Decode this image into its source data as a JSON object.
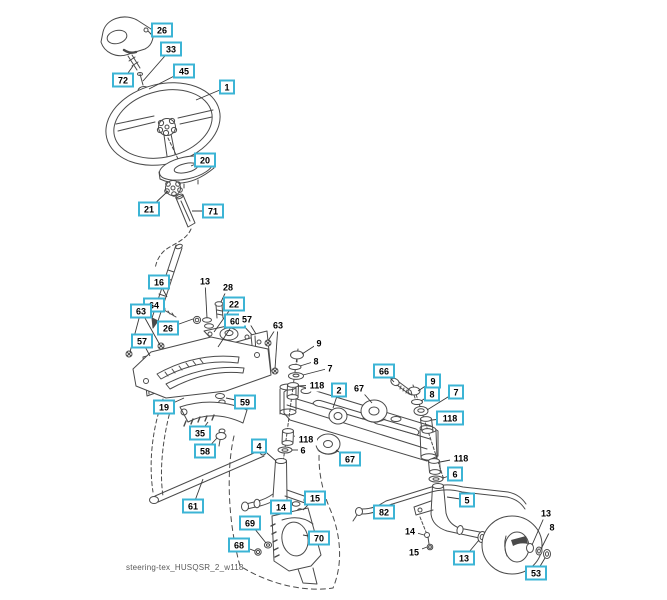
{
  "diagram": {
    "footer": "steering-tex_HUSQSR_2_w118",
    "colors": {
      "callout_border": "#3cb4d5",
      "callout_text": "#000000",
      "line": "#4a4a4a",
      "footer_text": "#595959",
      "background": "#ffffff"
    },
    "callouts": [
      {
        "label": "26",
        "x": 162,
        "y": 30,
        "boxed": true,
        "leaders": [
          [
            150,
            34
          ]
        ]
      },
      {
        "label": "33",
        "x": 171,
        "y": 49,
        "boxed": true,
        "leaders": [
          [
            143,
            81
          ]
        ]
      },
      {
        "label": "45",
        "x": 184,
        "y": 71,
        "boxed": true,
        "leaders": [
          [
            149,
            89
          ]
        ]
      },
      {
        "label": "72",
        "x": 123,
        "y": 80,
        "boxed": true,
        "leaders": [
          [
            133,
            66
          ]
        ]
      },
      {
        "label": "1",
        "x": 227,
        "y": 87,
        "boxed": true,
        "leaders": [
          [
            196,
            100
          ]
        ]
      },
      {
        "label": "20",
        "x": 205,
        "y": 160,
        "boxed": true,
        "leaders": [
          [
            191,
            166
          ]
        ]
      },
      {
        "label": "21",
        "x": 149,
        "y": 209,
        "boxed": true,
        "leaders": [
          [
            168,
            191
          ]
        ]
      },
      {
        "label": "71",
        "x": 213,
        "y": 211,
        "boxed": true,
        "leaders": [
          [
            192,
            211
          ]
        ]
      },
      {
        "label": "16",
        "x": 159,
        "y": 282,
        "boxed": true,
        "leaders": [
          [
            167,
            297
          ]
        ]
      },
      {
        "label": "13",
        "x": 205,
        "y": 281,
        "boxed": false,
        "leaders": [
          [
            207,
            318
          ]
        ]
      },
      {
        "label": "28",
        "x": 228,
        "y": 287,
        "boxed": false,
        "leaders": [
          [
            221,
            302
          ]
        ]
      },
      {
        "label": "64",
        "x": 154,
        "y": 305,
        "boxed": true,
        "leaders": [
          [
            162,
            309
          ]
        ]
      },
      {
        "label": "22",
        "x": 234,
        "y": 304,
        "boxed": true,
        "leaders": [
          [
            214,
            332
          ]
        ]
      },
      {
        "label": "63",
        "x": 141,
        "y": 311,
        "boxed": true,
        "leaders": [
          [
            130,
            352
          ],
          [
            160,
            345
          ]
        ]
      },
      {
        "label": "26",
        "x": 168,
        "y": 328,
        "boxed": true,
        "leaders": [
          [
            193,
            319
          ]
        ]
      },
      {
        "label": "60",
        "x": 235,
        "y": 321,
        "boxed": true,
        "leaders": [
          [
            218,
            347
          ]
        ]
      },
      {
        "label": "57",
        "x": 247,
        "y": 319,
        "boxed": false,
        "leaders": [
          [
            256,
            334
          ]
        ]
      },
      {
        "label": "63",
        "x": 278,
        "y": 325,
        "boxed": false,
        "leaders": [
          [
            268,
            341
          ],
          [
            275,
            369
          ]
        ]
      },
      {
        "label": "57",
        "x": 142,
        "y": 341,
        "boxed": true,
        "leaders": [
          [
            150,
            356
          ]
        ]
      },
      {
        "label": "9",
        "x": 319,
        "y": 343,
        "boxed": false,
        "leaders": [
          [
            302,
            354
          ]
        ]
      },
      {
        "label": "8",
        "x": 316,
        "y": 361,
        "boxed": false,
        "leaders": [
          [
            300,
            366
          ]
        ]
      },
      {
        "label": "7",
        "x": 330,
        "y": 368,
        "boxed": false,
        "leaders": [
          [
            303,
            375
          ]
        ]
      },
      {
        "label": "118",
        "x": 317,
        "y": 385,
        "boxed": false,
        "leaders": [
          [
            298,
            386
          ]
        ]
      },
      {
        "label": "2",
        "x": 339,
        "y": 390,
        "boxed": true,
        "leaders": [
          [
            333,
            408
          ]
        ]
      },
      {
        "label": "67",
        "x": 359,
        "y": 388,
        "boxed": false,
        "leaders": [
          [
            372,
            403
          ]
        ]
      },
      {
        "label": "66",
        "x": 384,
        "y": 371,
        "boxed": true,
        "leaders": [
          [
            394,
            382
          ]
        ]
      },
      {
        "label": "9",
        "x": 433,
        "y": 381,
        "boxed": true,
        "leaders": [
          [
            418,
            391
          ]
        ]
      },
      {
        "label": "8",
        "x": 432,
        "y": 394,
        "boxed": true,
        "leaders": [
          [
            421,
            401
          ]
        ]
      },
      {
        "label": "7",
        "x": 456,
        "y": 392,
        "boxed": true,
        "leaders": [
          [
            427,
            410
          ]
        ]
      },
      {
        "label": "118",
        "x": 450,
        "y": 418,
        "boxed": true,
        "leaders": [
          [
            432,
            420
          ]
        ]
      },
      {
        "label": "19",
        "x": 164,
        "y": 407,
        "boxed": true,
        "leaders": [
          [
            184,
            398
          ]
        ]
      },
      {
        "label": "59",
        "x": 245,
        "y": 402,
        "boxed": true,
        "leaders": [
          [
            226,
            398
          ]
        ]
      },
      {
        "label": "35",
        "x": 200,
        "y": 433,
        "boxed": true,
        "leaders": [
          [
            208,
            422
          ]
        ]
      },
      {
        "label": "58",
        "x": 205,
        "y": 451,
        "boxed": true,
        "leaders": [
          [
            217,
            438
          ]
        ]
      },
      {
        "label": "118",
        "x": 306,
        "y": 439,
        "boxed": false,
        "leaders": [
          [
            294,
            436
          ]
        ]
      },
      {
        "label": "6",
        "x": 303,
        "y": 450,
        "boxed": false,
        "leaders": [
          [
            292,
            450
          ]
        ]
      },
      {
        "label": "4",
        "x": 259,
        "y": 446,
        "boxed": true,
        "leaders": [
          [
            276,
            461
          ]
        ]
      },
      {
        "label": "67",
        "x": 350,
        "y": 459,
        "boxed": true,
        "leaders": [
          [
            336,
            450
          ]
        ]
      },
      {
        "label": "61",
        "x": 193,
        "y": 506,
        "boxed": true,
        "leaders": [
          [
            203,
            479
          ]
        ]
      },
      {
        "label": "15",
        "x": 315,
        "y": 498,
        "boxed": true,
        "leaders": [
          [
            303,
            510
          ]
        ]
      },
      {
        "label": "14",
        "x": 281,
        "y": 507,
        "boxed": true,
        "leaders": [
          [
            293,
            504
          ]
        ]
      },
      {
        "label": "82",
        "x": 384,
        "y": 512,
        "boxed": true,
        "leaders": [
          [
            392,
            504
          ]
        ]
      },
      {
        "label": "69",
        "x": 250,
        "y": 523,
        "boxed": true,
        "leaders": [
          [
            266,
            543
          ]
        ]
      },
      {
        "label": "68",
        "x": 239,
        "y": 545,
        "boxed": true,
        "leaders": [
          [
            255,
            551
          ]
        ]
      },
      {
        "label": "70",
        "x": 319,
        "y": 538,
        "boxed": true,
        "leaders": [
          [
            303,
            535
          ]
        ]
      },
      {
        "label": "118",
        "x": 461,
        "y": 458,
        "boxed": false,
        "leaders": [
          [
            440,
            462
          ]
        ]
      },
      {
        "label": "6",
        "x": 455,
        "y": 474,
        "boxed": true,
        "leaders": [
          [
            443,
            478
          ]
        ]
      },
      {
        "label": "5",
        "x": 467,
        "y": 500,
        "boxed": true,
        "leaders": [
          [
            447,
            497
          ]
        ]
      },
      {
        "label": "14",
        "x": 410,
        "y": 531,
        "boxed": false,
        "leaders": [
          [
            424,
            535
          ]
        ]
      },
      {
        "label": "15",
        "x": 414,
        "y": 552,
        "boxed": false,
        "leaders": [
          [
            427,
            547
          ]
        ]
      },
      {
        "label": "13",
        "x": 464,
        "y": 558,
        "boxed": true,
        "leaders": [
          [
            479,
            540
          ]
        ]
      },
      {
        "label": "13",
        "x": 546,
        "y": 513,
        "boxed": false,
        "leaders": [
          [
            532,
            545
          ]
        ]
      },
      {
        "label": "8",
        "x": 552,
        "y": 527,
        "boxed": false,
        "leaders": [
          [
            541,
            549
          ]
        ]
      },
      {
        "label": "53",
        "x": 536,
        "y": 573,
        "boxed": true,
        "leaders": [
          [
            545,
            558
          ]
        ]
      }
    ]
  }
}
